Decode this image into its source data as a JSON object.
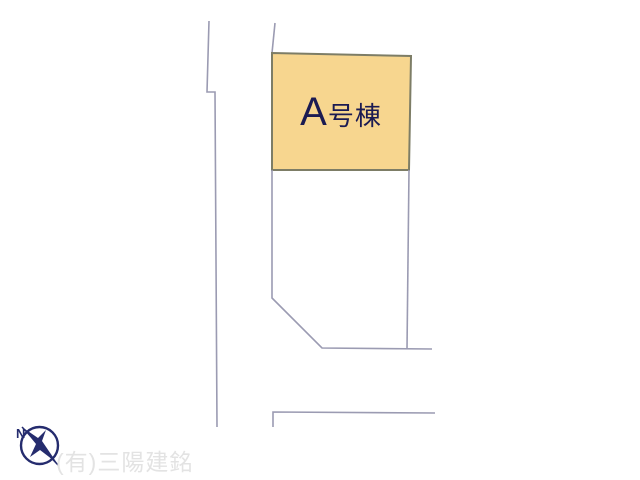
{
  "title": "区画図",
  "colors": {
    "background": "#ffffff",
    "parcel_a_fill": "#f7d68f",
    "parcel_a_border": "#7d7d66",
    "road_line": "#9b9bb2",
    "parcel_label_text": "#1b1b52",
    "compass": "#252c6e",
    "watermark_text": "#e3e3e3"
  },
  "parcel_a": {
    "label_letter": "A",
    "label_suffix": "号棟",
    "points": "272,53 411,56 409,170 272,170"
  },
  "lines": {
    "road_left": "209,21 207,92 215,92 217,427",
    "road_right_top": "275,23 272,53",
    "parcel_b_outline": "272,170 272,298 322,348 432,349",
    "parcel_b_right": "409,170 407,349",
    "road_bottom": "273,427 273,412 435,413"
  },
  "compass": {
    "north_label": "N"
  },
  "watermark": {
    "company": "(有)三陽建銘"
  }
}
